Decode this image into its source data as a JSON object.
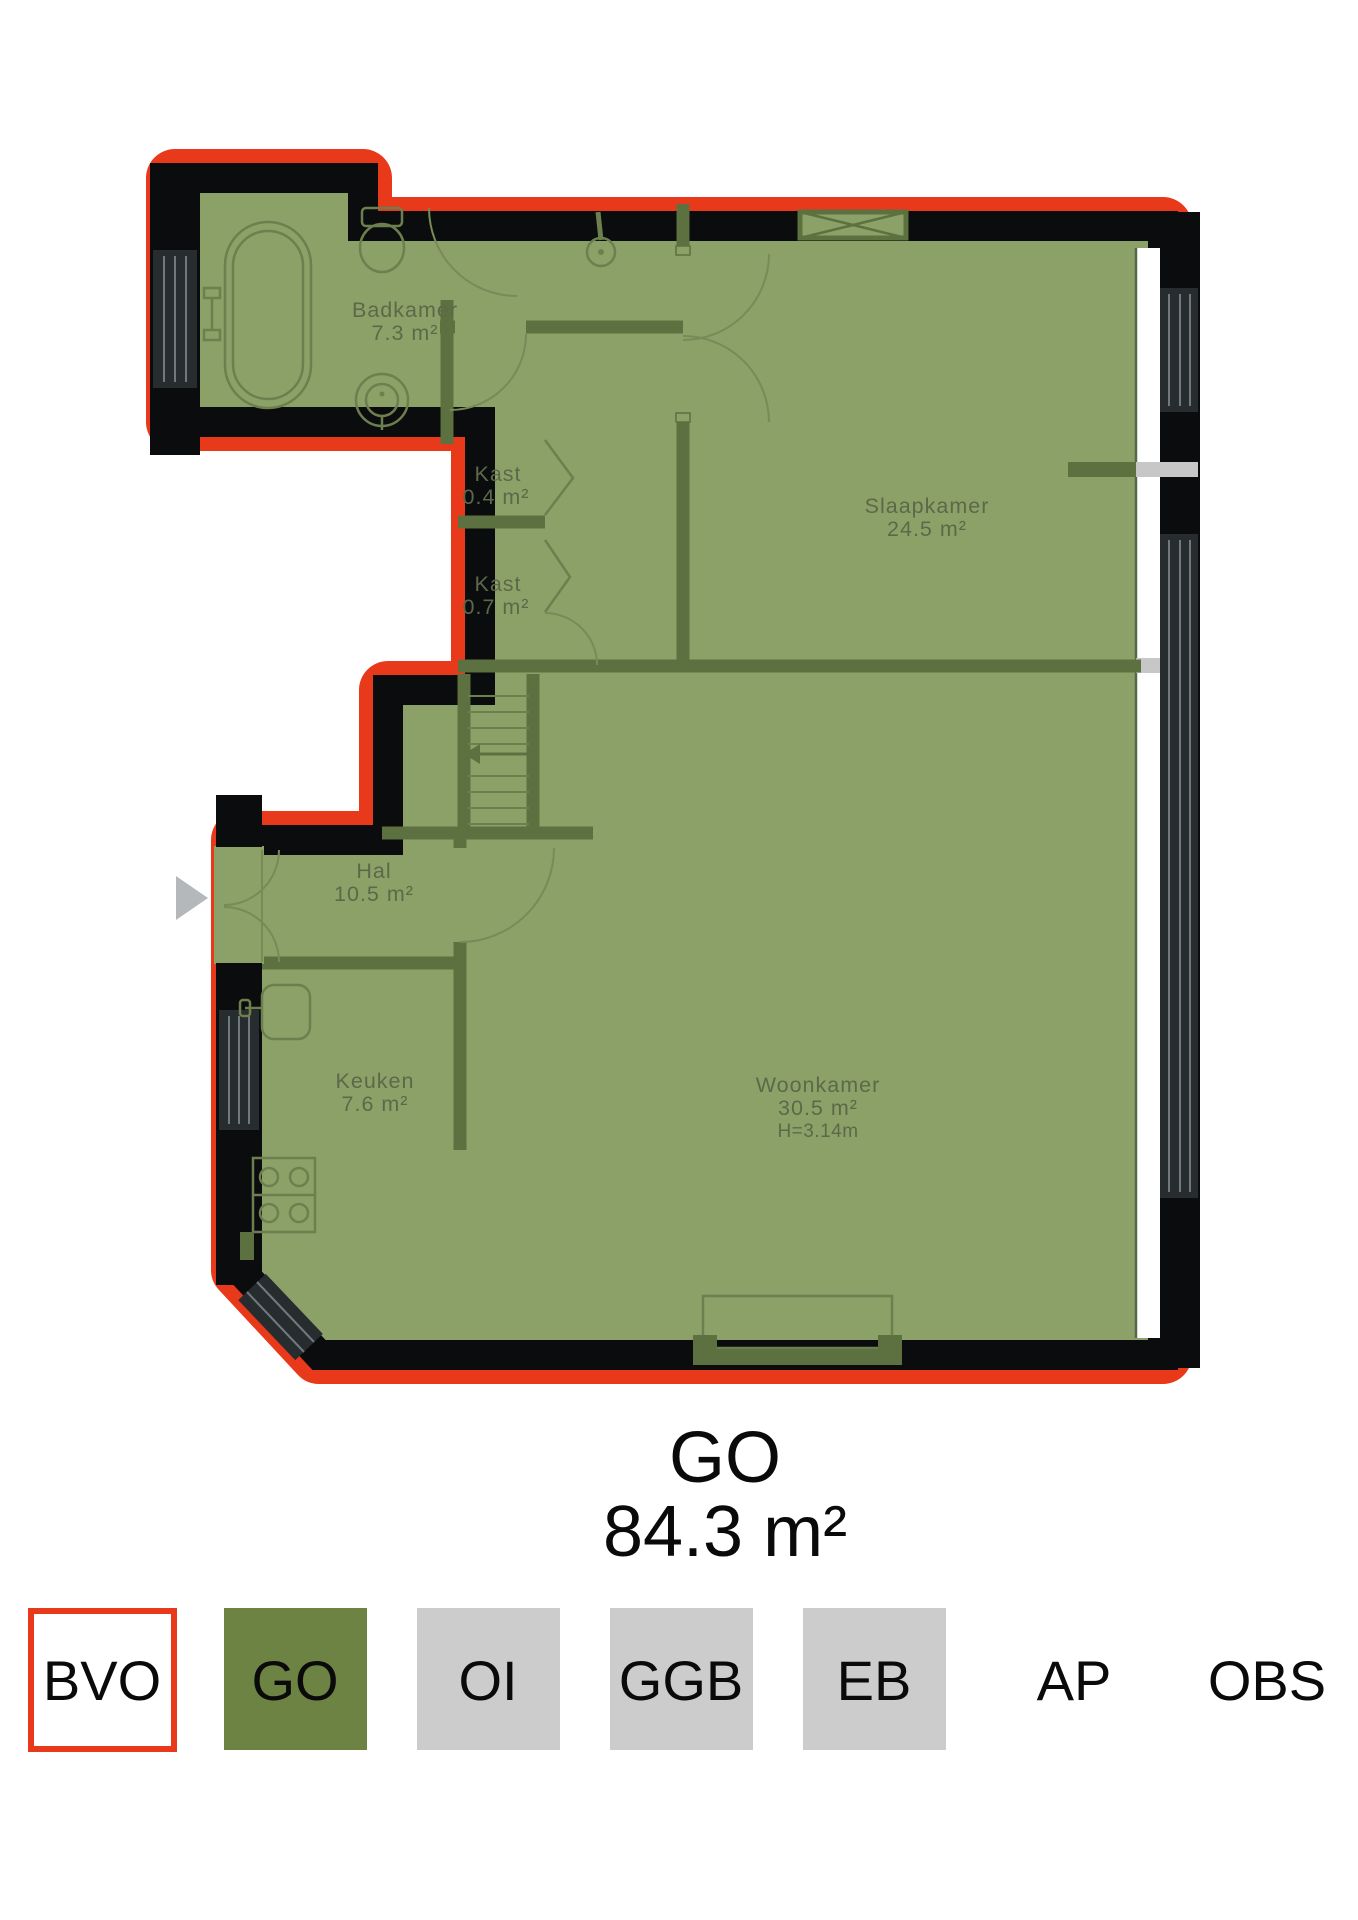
{
  "plan": {
    "rooms": {
      "badkamer": {
        "name": "Badkamer",
        "area": "7.3 m²"
      },
      "kast_small": {
        "name": "Kast",
        "area": "0.4 m²"
      },
      "kast_large": {
        "name": "Kast",
        "area": "0.7 m²"
      },
      "slaapkamer": {
        "name": "Slaapkamer",
        "area": "24.5 m²"
      },
      "hal": {
        "name": "Hal",
        "area": "10.5 m²"
      },
      "keuken": {
        "name": "Keuken",
        "area": "7.6 m²"
      },
      "woonkamer": {
        "name": "Woonkamer",
        "area": "30.5 m²",
        "ceiling_height": "H=3.14m"
      }
    },
    "icons": {
      "entrance": "entrance-arrow-icon",
      "stairs": "stairs-icon",
      "bathtub": "bathtub-icon",
      "toilet": "toilet-icon",
      "washbasin": "washbasin-icon",
      "shower": "shower-icon",
      "stove": "stove-icon",
      "kitchen_sink": "kitchen-sink-icon",
      "ventilation": "ventilation-icon",
      "hearth": "hearth-icon"
    }
  },
  "summary": {
    "label": "GO",
    "area": "84.3 m²"
  },
  "legend": {
    "items": [
      {
        "label": "BVO",
        "fill": "#ffffff",
        "style": "outlined"
      },
      {
        "label": "GO",
        "fill": "#6d8343",
        "style": "filled"
      },
      {
        "label": "OI",
        "fill": "#cccccc",
        "style": "filled"
      },
      {
        "label": "GGB",
        "fill": "#cccccc",
        "style": "filled"
      },
      {
        "label": "EB",
        "fill": "#cccccc",
        "style": "filled"
      },
      {
        "label": "AP",
        "fill": "none",
        "style": "text-only"
      },
      {
        "label": "OBS",
        "fill": "none",
        "style": "text-only"
      }
    ]
  },
  "colors": {
    "outline_red": "#e8391b",
    "go_area_green": "#8ca168",
    "legend_go_green": "#6d8343",
    "legend_gray": "#cccccc",
    "wall_black": "#0b0c0e",
    "interior_wall_green": "#5d7140"
  }
}
